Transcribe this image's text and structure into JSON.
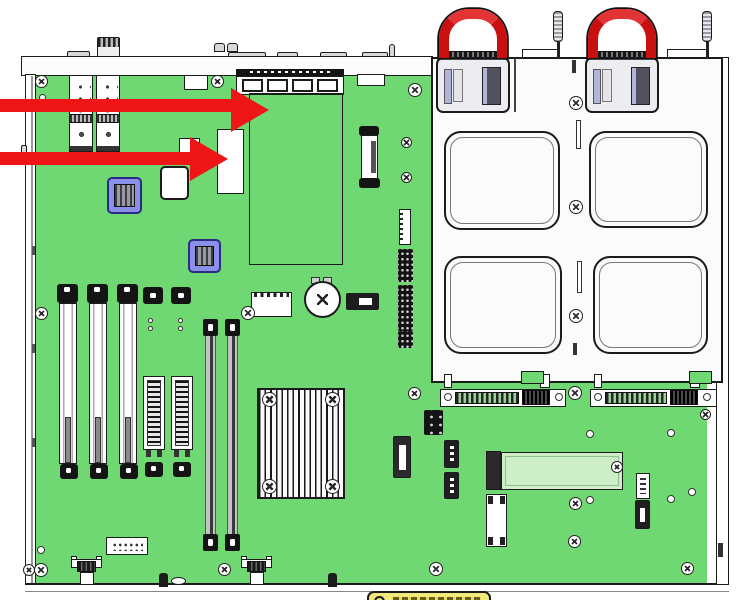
{
  "diagram": {
    "title": "server-chassis-internal-top-view",
    "description": "Line-art service diagram of a 1U server: green motherboard on left, drive cage and dual PSUs with red handles on right, two red callout arrows pointing at the riser region and a connector module",
    "callouts": [
      {
        "id": 1,
        "shape": "red-arrow",
        "direction": "right",
        "points_to": "daughterboard-region"
      },
      {
        "id": 2,
        "shape": "red-arrow",
        "direction": "right",
        "points_to": "connector-module"
      }
    ],
    "components": [
      "chassis-frame",
      "motherboard",
      "sfp-cage-1",
      "sfp-cage-2",
      "rear-io-bank",
      "daughterboard-outline",
      "connector-module",
      "blue-chip-1",
      "blue-chip-2",
      "pcie-slot-1",
      "pcie-slot-2",
      "pcie-slot-3",
      "mezz-connector-1",
      "mezz-connector-2",
      "dimm-slot-1",
      "dimm-slot-2",
      "cpu-heatsink",
      "coin-battery",
      "jumper-block",
      "riser-connector",
      "pin-headers",
      "drive-cage",
      "drive-bay-cutout-1",
      "drive-bay-cutout-2",
      "drive-bay-cutout-3",
      "drive-bay-cutout-4",
      "psu-1",
      "psu-2",
      "psu-handle-1",
      "psu-handle-2",
      "thumbscrew-1",
      "thumbscrew-2",
      "edge-connector-1",
      "edge-connector-2",
      "m2-ssd",
      "sata-header",
      "front-panel-connector-1",
      "front-panel-connector-2",
      "warning-label-partial"
    ]
  },
  "colors": {
    "pcb_green": "#70d873",
    "m2_green": "#cdeec6",
    "ink": "#1b1b1b",
    "metal": "#ffffff",
    "arrow_red": "#ed1515",
    "handle_red": "#c90f0f",
    "component_blue": "#8a90e8",
    "psu_gray": "#ececf1",
    "lavender": "#b1b5da",
    "label_yellow": "#f2e87c"
  }
}
